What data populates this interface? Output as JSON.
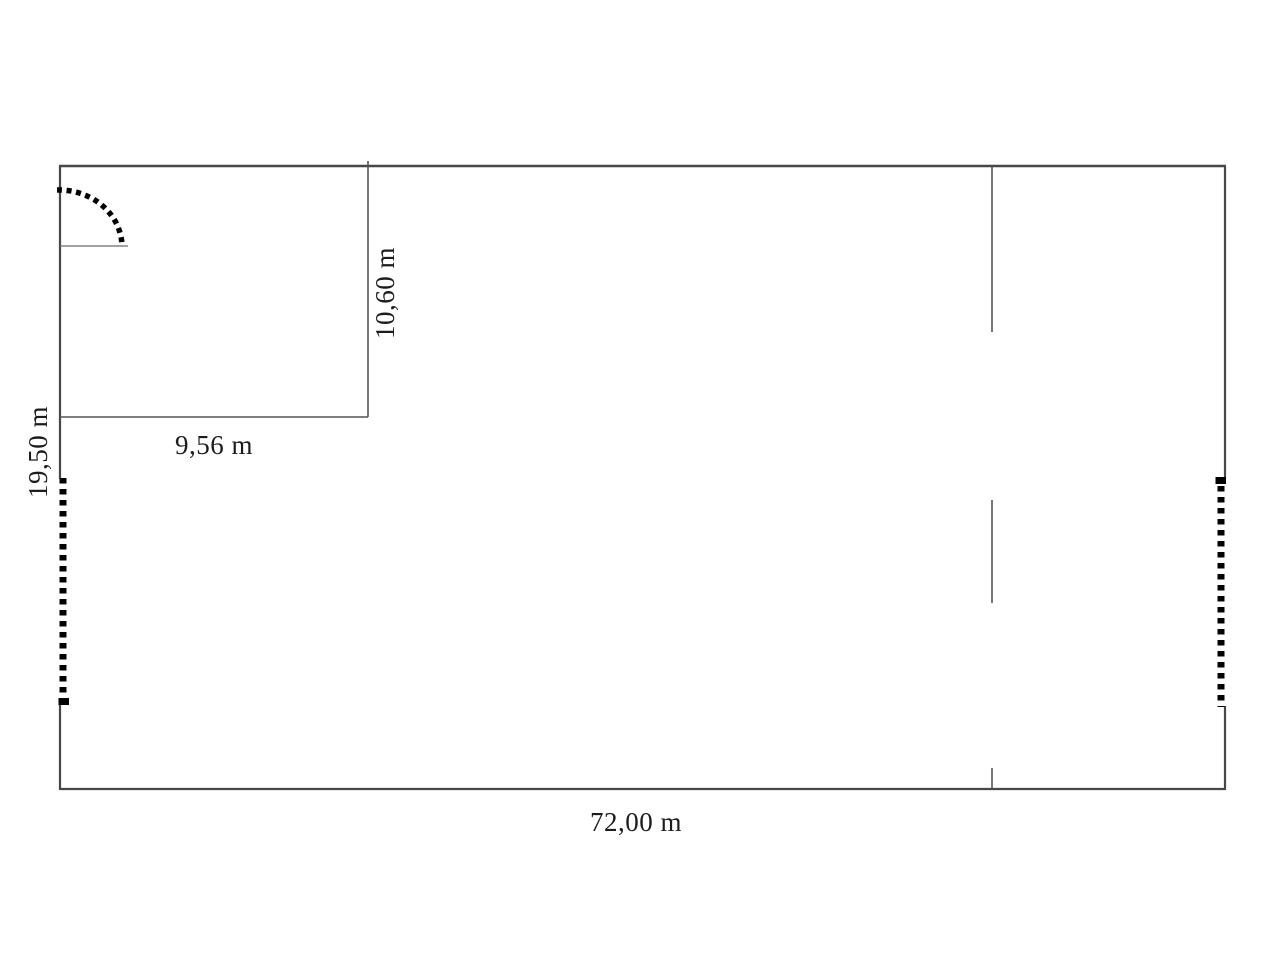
{
  "diagram": {
    "type": "floor-plan",
    "background_color": "#ffffff",
    "wall_color": "#474747",
    "marker_color": "#000000",
    "text_color": "#1c1c1c",
    "labels": {
      "total_width": "72,00 m",
      "total_height": "19,50 m",
      "room_width": "9,56 m",
      "room_height": "10,60 m"
    },
    "features": [
      "outer-walls",
      "inner-room",
      "door-swing",
      "left-wall-opening",
      "right-wall-opening",
      "partition-wall-with-gaps"
    ]
  }
}
